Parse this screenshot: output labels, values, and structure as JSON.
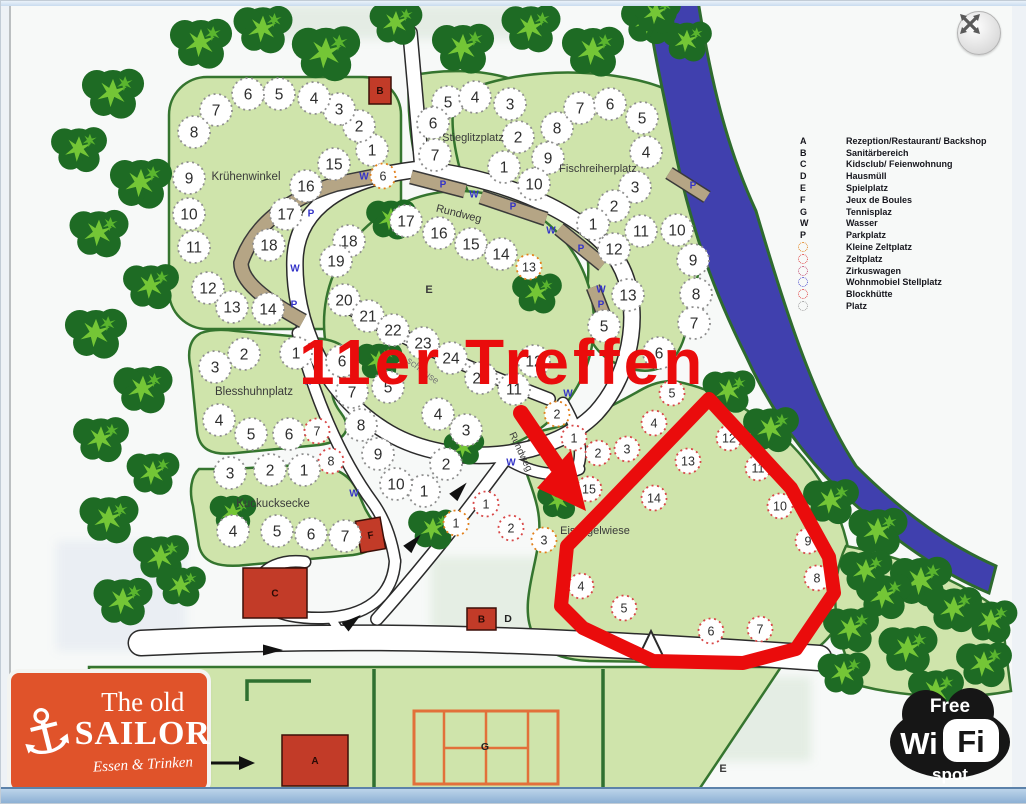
{
  "window": {
    "close_icon": "expand-arrows"
  },
  "annotation": {
    "title": "11er Treffen",
    "color": "#ea0c0c",
    "outline_points": "605,505 708,398 790,487 828,556 833,592 795,648 742,662 652,660 582,627 560,605 566,545 605,505",
    "arrow": {
      "x1": 520,
      "y1": 412,
      "x2": 556,
      "y2": 465,
      "head": "585,510 536,487 570,449"
    }
  },
  "legend": {
    "items": [
      {
        "key": "A",
        "type": "letter",
        "label": "Rezeption/Restaurant/ Backshop"
      },
      {
        "key": "B",
        "type": "letter",
        "label": "Sanitärbereich"
      },
      {
        "key": "C",
        "type": "letter",
        "label": "Kidsclub/ Feienwohnung"
      },
      {
        "key": "D",
        "type": "letter",
        "label": "Hausmüll"
      },
      {
        "key": "E",
        "type": "letter",
        "label": "Spielplatz"
      },
      {
        "key": "F",
        "type": "letter",
        "label": "Jeux de Boules"
      },
      {
        "key": "G",
        "type": "letter",
        "label": "Tennisplaz"
      },
      {
        "key": "W",
        "type": "letter",
        "label": "Wasser"
      },
      {
        "key": "P",
        "type": "letter",
        "label": "Parkplatz"
      },
      {
        "key": "",
        "type": "dot",
        "color": "#e0821c",
        "label": "Kleine Zeltplatz"
      },
      {
        "key": "",
        "type": "dot",
        "color": "#e04545",
        "label": "Zeltplatz"
      },
      {
        "key": "",
        "type": "dot",
        "color": "#c04a70",
        "label": "Zirkuswagen"
      },
      {
        "key": "",
        "type": "dot",
        "color": "#5050cc",
        "label": "Wohnmobiel Stellplatz"
      },
      {
        "key": "",
        "type": "dot",
        "color": "#e04545",
        "label": "Blockhütte"
      },
      {
        "key": "",
        "type": "dot",
        "color": "#9a9a9a",
        "label": "Platz"
      }
    ]
  },
  "areas": [
    {
      "text": "Krühenwinkel",
      "x": 245,
      "y": 179,
      "fs": 11.5,
      "bold": false,
      "rot": 0
    },
    {
      "text": "Stieglitzplatz",
      "x": 472,
      "y": 140,
      "fs": 11,
      "bold": false,
      "rot": 0
    },
    {
      "text": "Fischreiherplatz",
      "x": 597,
      "y": 171,
      "fs": 11,
      "bold": false,
      "rot": 0
    },
    {
      "text": "Blesshuhnplatz",
      "x": 253,
      "y": 394,
      "fs": 11.5,
      "bold": false,
      "rot": 0
    },
    {
      "text": "Kuckucksecke",
      "x": 272,
      "y": 506,
      "fs": 11.5,
      "bold": false,
      "rot": 0
    },
    {
      "text": "Eisvogelwiese",
      "x": 594,
      "y": 533,
      "fs": 11,
      "bold": false,
      "rot": 0
    },
    {
      "text": "E",
      "x": 428,
      "y": 292,
      "fs": 11,
      "bold": true,
      "rot": 0
    },
    {
      "text": "E",
      "x": 722,
      "y": 771,
      "fs": 11,
      "bold": true,
      "rot": 0
    },
    {
      "text": "Rundweg",
      "x": 457,
      "y": 216,
      "fs": 11,
      "bold": false,
      "rot": 14
    },
    {
      "text": "Rundweg",
      "x": 517,
      "y": 452,
      "fs": 10,
      "bold": false,
      "rot": 65
    },
    {
      "text": "schleuse",
      "x": 420,
      "y": 372,
      "fs": 9.5,
      "bold": false,
      "rot": 37
    }
  ],
  "buildings": [
    {
      "letter": "B",
      "x": 368,
      "y": 76,
      "w": 22,
      "h": 27,
      "rot": 0
    },
    {
      "letter": "C",
      "x": 242,
      "y": 567,
      "w": 64,
      "h": 50,
      "rot": 0
    },
    {
      "letter": "F",
      "x": 357,
      "y": 518,
      "w": 25,
      "h": 32,
      "rot": -10
    },
    {
      "letter": "B",
      "x": 466,
      "y": 607,
      "w": 29,
      "h": 22,
      "rot": 0
    },
    {
      "letter": "A",
      "x": 281,
      "y": 734,
      "w": 66,
      "h": 51,
      "rot": 0
    }
  ],
  "extra_labels": [
    {
      "text": "D",
      "x": 507,
      "y": 621
    },
    {
      "text": "G",
      "x": 484,
      "y": 749
    }
  ],
  "markers": {
    "w_label": "W",
    "p_label": "P",
    "w": [
      [
        363,
        175
      ],
      [
        473,
        193
      ],
      [
        550,
        229
      ],
      [
        600,
        288
      ],
      [
        294,
        267
      ],
      [
        307,
        380
      ],
      [
        353,
        492
      ],
      [
        510,
        461
      ],
      [
        567,
        392
      ]
    ],
    "p": [
      [
        310,
        212
      ],
      [
        293,
        303
      ],
      [
        442,
        183
      ],
      [
        512,
        205
      ],
      [
        580,
        247
      ],
      [
        600,
        303
      ],
      [
        692,
        184
      ]
    ]
  },
  "plots": [
    [
      371,
      149,
      "1",
      "g"
    ],
    [
      358,
      125,
      "2",
      "g"
    ],
    [
      338,
      108,
      "3",
      "g"
    ],
    [
      313,
      97,
      "4",
      "g"
    ],
    [
      278,
      93,
      "5",
      "g"
    ],
    [
      247,
      93,
      "6",
      "g"
    ],
    [
      215,
      109,
      "7",
      "g"
    ],
    [
      193,
      131,
      "8",
      "g"
    ],
    [
      188,
      177,
      "9",
      "g"
    ],
    [
      188,
      213,
      "10",
      "g"
    ],
    [
      193,
      246,
      "11",
      "g"
    ],
    [
      207,
      287,
      "12",
      "g"
    ],
    [
      231,
      306,
      "13",
      "g"
    ],
    [
      267,
      308,
      "14",
      "g"
    ],
    [
      333,
      163,
      "15",
      "g"
    ],
    [
      305,
      185,
      "16",
      "g"
    ],
    [
      285,
      213,
      "17",
      "g"
    ],
    [
      268,
      244,
      "18",
      "g"
    ],
    [
      382,
      175,
      "6",
      "o"
    ],
    [
      447,
      101,
      "5",
      "g"
    ],
    [
      474,
      96,
      "4",
      "g"
    ],
    [
      509,
      103,
      "3",
      "g"
    ],
    [
      517,
      136,
      "2",
      "g"
    ],
    [
      503,
      166,
      "1",
      "g"
    ],
    [
      432,
      122,
      "6",
      "g"
    ],
    [
      434,
      154,
      "7",
      "g"
    ],
    [
      556,
      127,
      "8",
      "g"
    ],
    [
      547,
      157,
      "9",
      "g"
    ],
    [
      533,
      183,
      "10",
      "g"
    ],
    [
      579,
      107,
      "7",
      "g"
    ],
    [
      609,
      103,
      "6",
      "g"
    ],
    [
      641,
      117,
      "5",
      "g"
    ],
    [
      645,
      151,
      "4",
      "g"
    ],
    [
      634,
      186,
      "3",
      "g"
    ],
    [
      613,
      205,
      "2",
      "g"
    ],
    [
      592,
      223,
      "1",
      "g"
    ],
    [
      640,
      230,
      "11",
      "g"
    ],
    [
      676,
      229,
      "10",
      "g"
    ],
    [
      692,
      259,
      "9",
      "g"
    ],
    [
      695,
      293,
      "8",
      "g"
    ],
    [
      693,
      322,
      "7",
      "g"
    ],
    [
      613,
      248,
      "12",
      "g"
    ],
    [
      627,
      294,
      "13",
      "g"
    ],
    [
      603,
      325,
      "5",
      "g"
    ],
    [
      658,
      352,
      "6",
      "g"
    ],
    [
      405,
      220,
      "17",
      "g"
    ],
    [
      438,
      232,
      "16",
      "g"
    ],
    [
      470,
      243,
      "15",
      "g"
    ],
    [
      500,
      253,
      "14",
      "g"
    ],
    [
      528,
      266,
      "13",
      "o"
    ],
    [
      348,
      240,
      "18",
      "g"
    ],
    [
      335,
      260,
      "19",
      "g"
    ],
    [
      343,
      299,
      "20",
      "g"
    ],
    [
      367,
      315,
      "21",
      "g"
    ],
    [
      392,
      329,
      "22",
      "g"
    ],
    [
      422,
      342,
      "23",
      "g"
    ],
    [
      450,
      357,
      "24",
      "g"
    ],
    [
      480,
      377,
      "25",
      "g"
    ],
    [
      513,
      388,
      "11",
      "g"
    ],
    [
      533,
      360,
      "12",
      "g"
    ],
    [
      341,
      360,
      "6",
      "g"
    ],
    [
      387,
      386,
      "5",
      "g"
    ],
    [
      437,
      413,
      "4",
      "g"
    ],
    [
      465,
      429,
      "3",
      "g"
    ],
    [
      445,
      463,
      "2",
      "g"
    ],
    [
      423,
      490,
      "1",
      "g"
    ],
    [
      351,
      391,
      "7",
      "g"
    ],
    [
      360,
      424,
      "8",
      "g"
    ],
    [
      377,
      453,
      "9",
      "g"
    ],
    [
      395,
      483,
      "10",
      "g"
    ],
    [
      295,
      352,
      "1",
      "g"
    ],
    [
      243,
      353,
      "2",
      "g"
    ],
    [
      214,
      366,
      "3",
      "g"
    ],
    [
      218,
      419,
      "4",
      "g"
    ],
    [
      250,
      433,
      "5",
      "g"
    ],
    [
      288,
      433,
      "6",
      "g"
    ],
    [
      316,
      430,
      "7",
      "r"
    ],
    [
      330,
      460,
      "8",
      "r"
    ],
    [
      303,
      469,
      "1",
      "g"
    ],
    [
      269,
      469,
      "2",
      "g"
    ],
    [
      229,
      472,
      "3",
      "g"
    ],
    [
      232,
      530,
      "4",
      "g"
    ],
    [
      276,
      530,
      "5",
      "g"
    ],
    [
      310,
      533,
      "6",
      "g"
    ],
    [
      344,
      535,
      "7",
      "g"
    ],
    [
      455,
      522,
      "1",
      "o"
    ],
    [
      485,
      503,
      "1",
      "r"
    ],
    [
      510,
      527,
      "2",
      "r"
    ],
    [
      543,
      539,
      "3",
      "o"
    ],
    [
      556,
      413,
      "2",
      "o"
    ],
    [
      573,
      437,
      "1",
      "r"
    ],
    [
      597,
      452,
      "2",
      "r"
    ],
    [
      626,
      448,
      "3",
      "r"
    ],
    [
      653,
      422,
      "4",
      "r"
    ],
    [
      671,
      392,
      "5",
      "r"
    ],
    [
      580,
      585,
      "4",
      "r"
    ],
    [
      623,
      607,
      "5",
      "r"
    ],
    [
      710,
      630,
      "6",
      "r"
    ],
    [
      759,
      628,
      "7",
      "r"
    ],
    [
      816,
      577,
      "8",
      "r"
    ],
    [
      807,
      540,
      "9",
      "r"
    ],
    [
      779,
      505,
      "10",
      "r"
    ],
    [
      757,
      467,
      "11",
      "r"
    ],
    [
      728,
      437,
      "12",
      "r"
    ],
    [
      687,
      460,
      "13",
      "r"
    ],
    [
      653,
      497,
      "14",
      "r"
    ],
    [
      588,
      488,
      "15",
      "r"
    ]
  ],
  "plot_colors": {
    "g": "#8f8f8f",
    "o": "#e2801c",
    "r": "#d84848"
  },
  "trees": [
    [
      200,
      42,
      1
    ],
    [
      262,
      28,
      0.95
    ],
    [
      325,
      52,
      1.1
    ],
    [
      395,
      22,
      0.85
    ],
    [
      462,
      47,
      1
    ],
    [
      530,
      27,
      0.95
    ],
    [
      592,
      50,
      1
    ],
    [
      648,
      20,
      0.9
    ],
    [
      686,
      40,
      0.8
    ],
    [
      655,
      12,
      0.8
    ],
    [
      112,
      92,
      1
    ],
    [
      78,
      148,
      0.9
    ],
    [
      140,
      182,
      1
    ],
    [
      98,
      232,
      0.95
    ],
    [
      150,
      285,
      0.9
    ],
    [
      95,
      332,
      1
    ],
    [
      142,
      388,
      0.95
    ],
    [
      100,
      438,
      0.9
    ],
    [
      152,
      472,
      0.85
    ],
    [
      108,
      518,
      0.95
    ],
    [
      160,
      556,
      0.9
    ],
    [
      122,
      600,
      0.95
    ],
    [
      180,
      585,
      0.8
    ],
    [
      390,
      218,
      0.8
    ],
    [
      378,
      360,
      0.75
    ],
    [
      432,
      528,
      0.8
    ],
    [
      232,
      512,
      0.75
    ],
    [
      536,
      292,
      0.8
    ],
    [
      558,
      500,
      0.7
    ],
    [
      463,
      447,
      0.65
    ],
    [
      728,
      390,
      0.85
    ],
    [
      770,
      428,
      0.9
    ],
    [
      830,
      500,
      0.9
    ],
    [
      877,
      530,
      0.95
    ],
    [
      920,
      580,
      1
    ],
    [
      883,
      595,
      0.9
    ],
    [
      850,
      628,
      0.9
    ],
    [
      907,
      648,
      0.95
    ],
    [
      953,
      608,
      0.9
    ],
    [
      983,
      663,
      0.9
    ],
    [
      865,
      570,
      0.85
    ],
    [
      843,
      672,
      0.85
    ],
    [
      935,
      690,
      0.9
    ],
    [
      990,
      620,
      0.85
    ]
  ],
  "logos": {
    "sailor": {
      "line1": "The old",
      "line2": "SAILOR",
      "line3": "Essen & Trinken",
      "anchor_icon": "anchor"
    },
    "wifi": {
      "free": "Free",
      "wi": "Wi",
      "fi": "Fi",
      "spot": "spot"
    }
  }
}
